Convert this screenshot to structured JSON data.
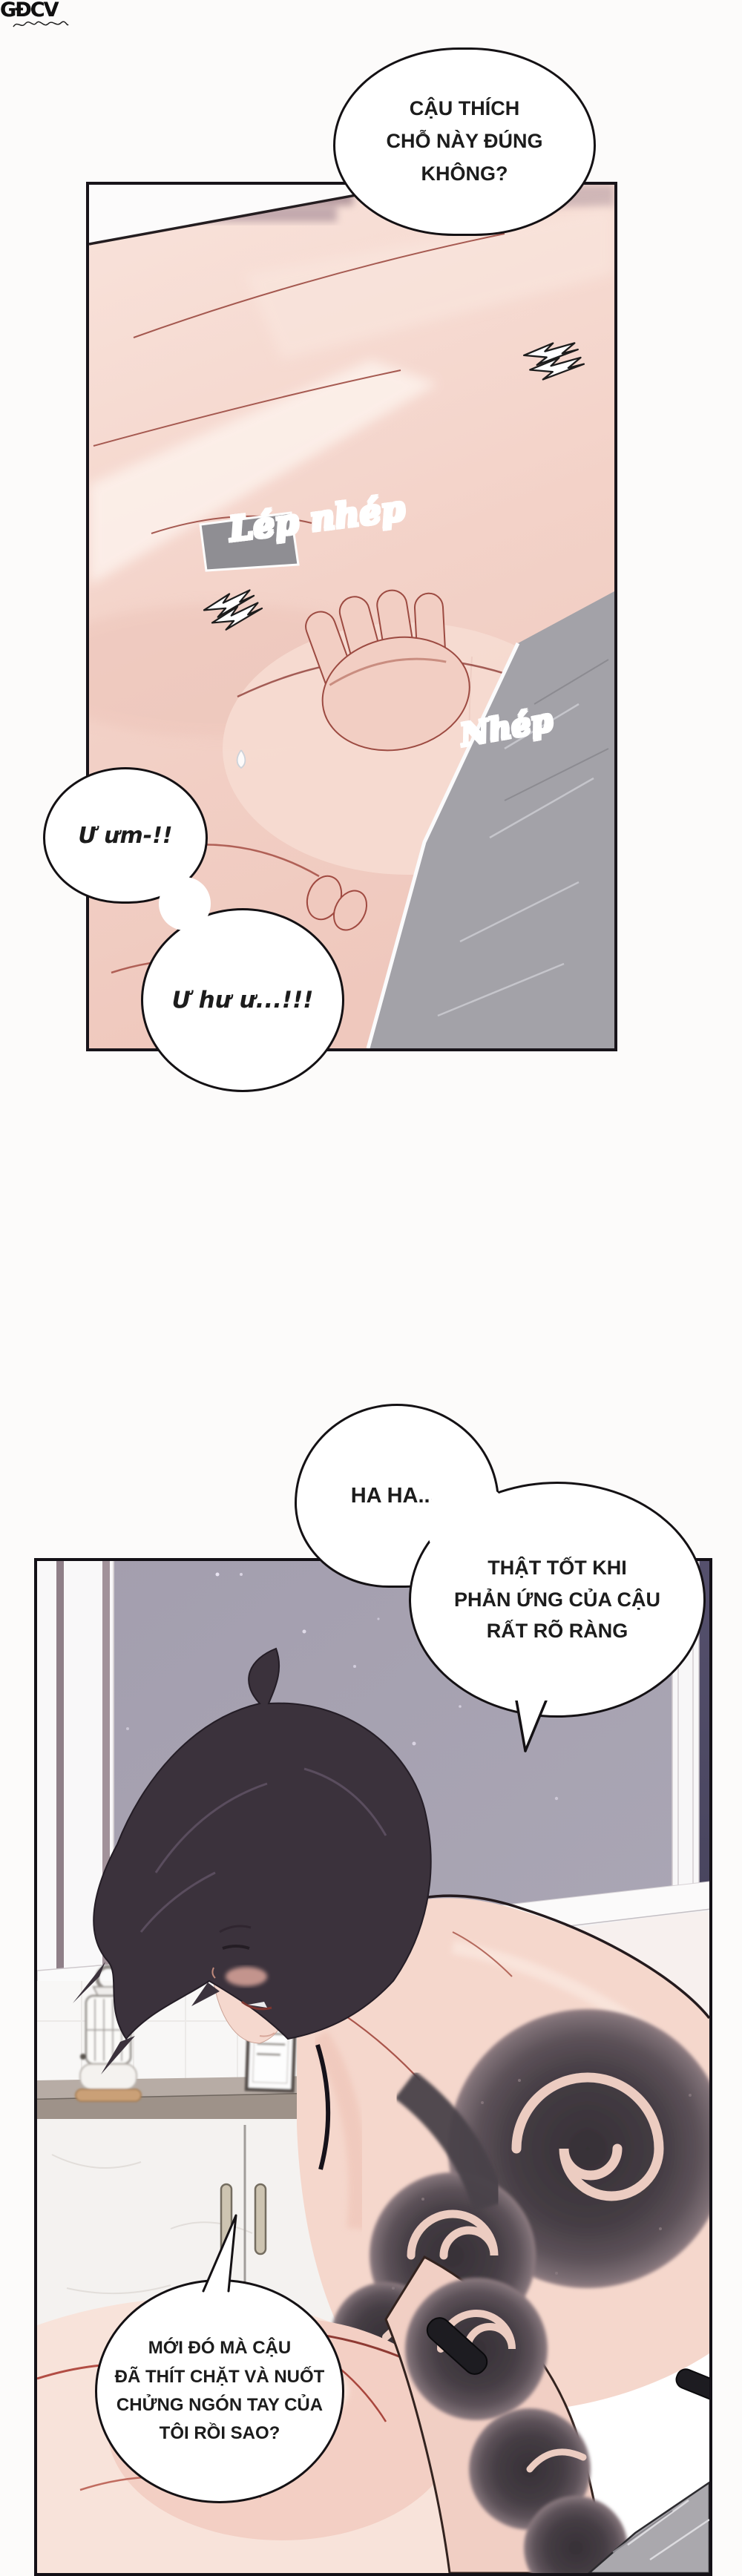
{
  "watermark": {
    "label": "GĐCV"
  },
  "panel1": {
    "bubble_top": {
      "lines": [
        "CẬU THÍCH",
        "CHỖ NÀY ĐÚNG",
        "KHÔNG?"
      ]
    },
    "sfx_large": "Lép nhép",
    "sfx_small": "Nhép",
    "moan_small": "Ư ưm-!!",
    "moan_large": "Ư hư ư...!!!"
  },
  "panel2": {
    "bubble_laugh": "HA HA...-",
    "bubble_reply": {
      "lines": [
        "THẬT TỐT KHI",
        "PHẢN ỨNG CỦA CẬU",
        "RẤT RÕ RÀNG"
      ]
    },
    "bubble_question": {
      "lines": [
        "MỚI ĐÓ MÀ CẬU",
        "ĐÃ THÍT CHẶT VÀ NUỐT",
        "CHỬNG NGÓN TAY CỦA",
        "TÔI RỒI SAO?"
      ]
    }
  },
  "colors": {
    "night_sky": "#a8a4b2",
    "skin": "#f4d6cb",
    "tattoo_ink": "#453d44",
    "sfx_gradient_start": "#2a1727",
    "sfx_gradient_end": "#d6336c",
    "outline": "#141114"
  }
}
